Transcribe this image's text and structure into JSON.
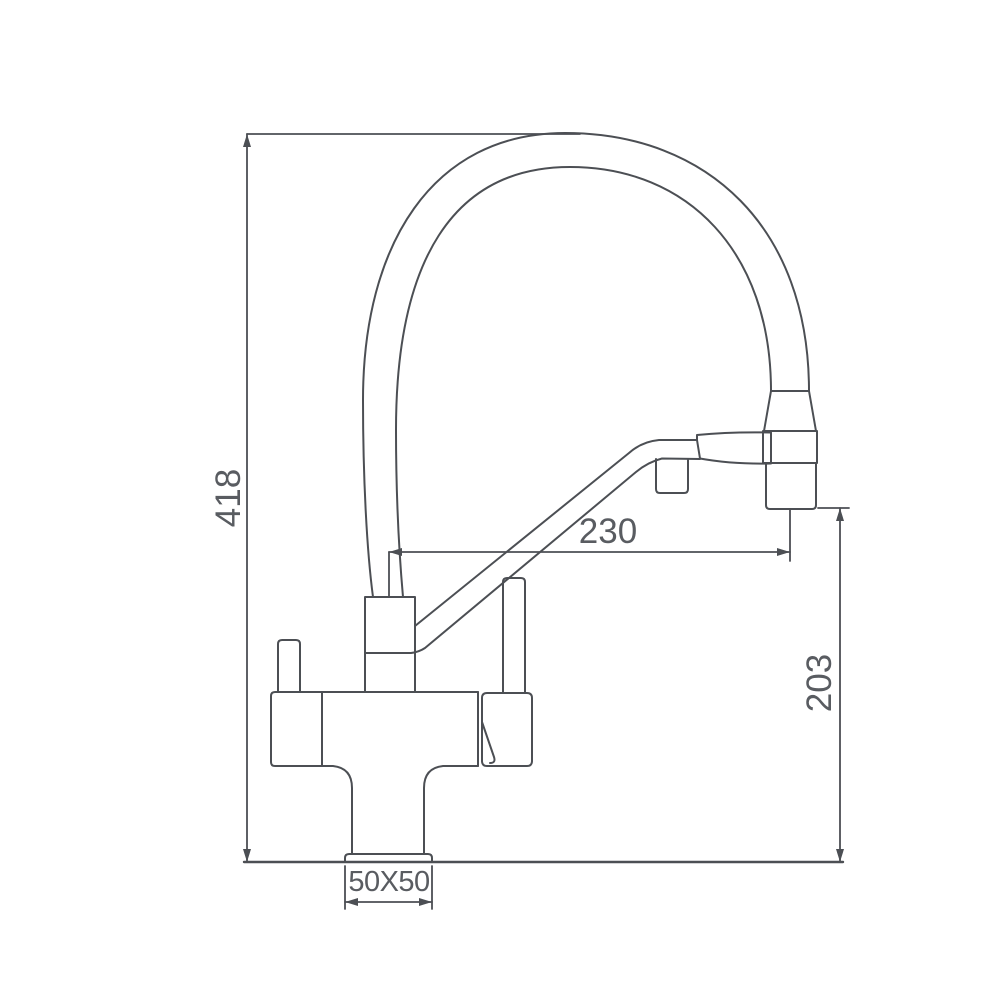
{
  "drawing": {
    "subject": "Kitchen faucet with flexible gooseneck hose and pull-out spray head, dimensioned technical line drawing",
    "colors": {
      "line": "#4c4f54",
      "label": "#595c61",
      "background": "#ffffff"
    },
    "dimensions": [
      {
        "id": "overall-height",
        "value": "418",
        "orientation": "vertical"
      },
      {
        "id": "spout-reach",
        "value": "230",
        "orientation": "horizontal"
      },
      {
        "id": "outlet-height",
        "value": "203",
        "orientation": "vertical"
      },
      {
        "id": "base-plate",
        "value": "50X50",
        "orientation": "horizontal"
      }
    ]
  }
}
